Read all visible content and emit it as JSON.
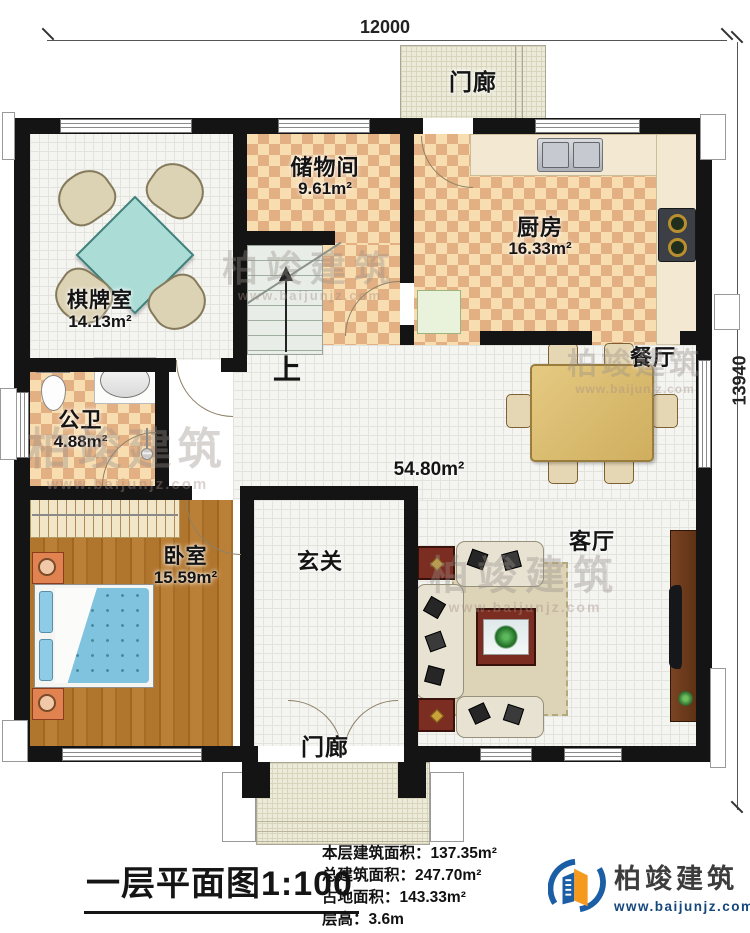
{
  "dimensions": {
    "width_mm": "12000",
    "height_mm": "13940"
  },
  "rooms": {
    "porch_top": {
      "name": "门廊"
    },
    "chess": {
      "name": "棋牌室",
      "area": "14.13m²"
    },
    "storage": {
      "name": "储物间",
      "area": "9.61m²"
    },
    "kitchen": {
      "name": "厨房",
      "area": "16.33m²"
    },
    "dining": {
      "name": "餐厅"
    },
    "bath": {
      "name": "公卫",
      "area": "4.88m²"
    },
    "bedroom": {
      "name": "卧室",
      "area": "15.59m²"
    },
    "foyer": {
      "name": "玄关"
    },
    "hall": {
      "area": "54.80m²"
    },
    "living": {
      "name": "客厅"
    },
    "porch_bottom": {
      "name": "门廊"
    }
  },
  "stairs": {
    "up_label": "上"
  },
  "title_block": {
    "plan_title": "一层平面图1:100",
    "stats": [
      {
        "label": "本层建筑面积：",
        "value": "137.35m²"
      },
      {
        "label": "总建筑面积：",
        "value": "247.70m²"
      },
      {
        "label": "占地面积：",
        "value": "143.33m²"
      },
      {
        "label": "层高：",
        "value": "3.6m"
      }
    ]
  },
  "brand": {
    "name": "柏竣建筑",
    "url": "www.baijunjz.com"
  },
  "watermark": {
    "text": "柏竣建筑",
    "subtext": "www.baijunjz.com"
  },
  "colors": {
    "wall": "#141414",
    "floor_checker_dark": "#e2b082",
    "floor_checker_light": "#f8ddb0",
    "table_teal": "#abdcd6",
    "bed_blue": "#7fc3de",
    "brand_blue": "#16477c",
    "brand_orange": "#f59a1d"
  }
}
